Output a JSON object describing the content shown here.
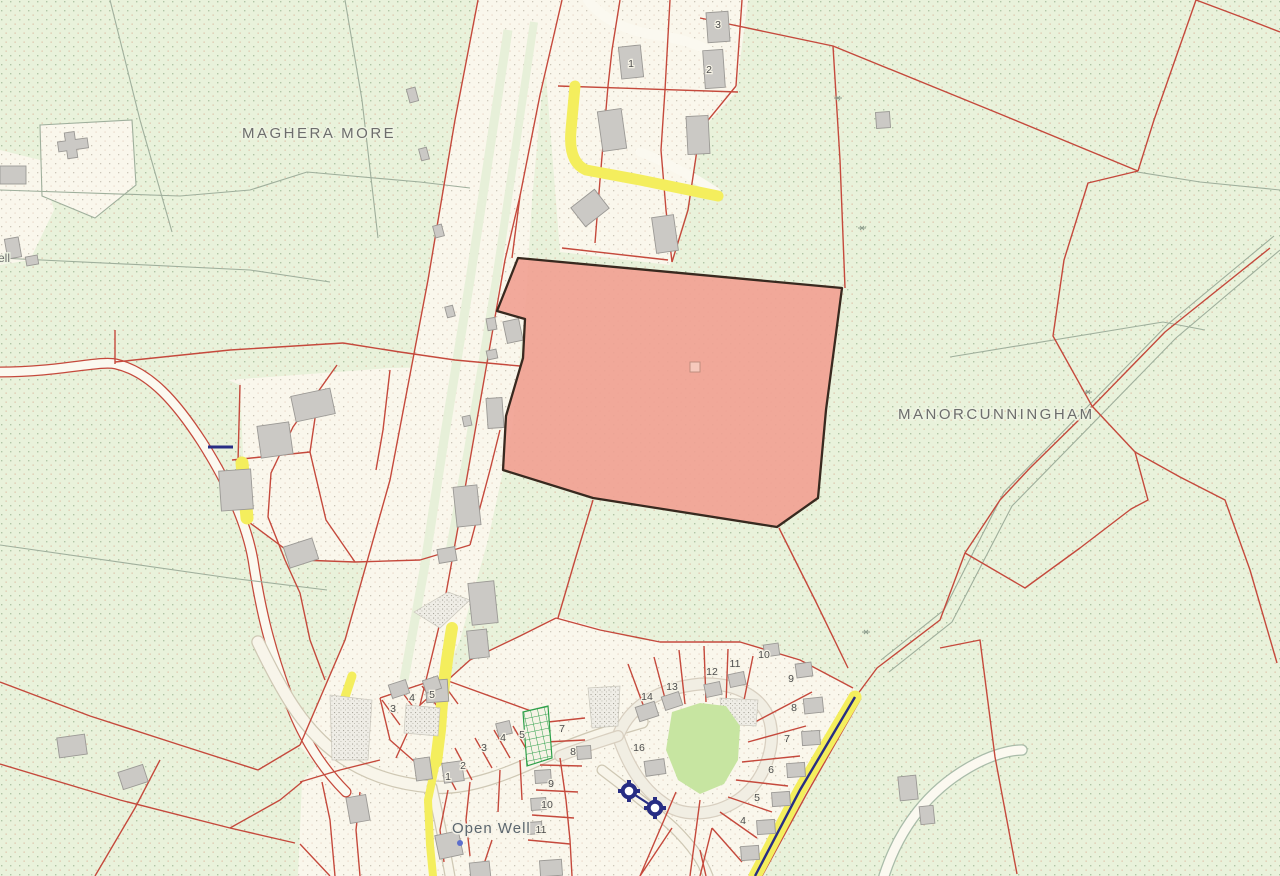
{
  "title": "Land parcel map",
  "place_labels": {
    "townland_1": "MAGHERA MORE",
    "townland_2": "MANORCUNNINGHAM",
    "well_label": "Open Well",
    "edge_label": "ell"
  },
  "plot_numbers": {
    "north": [
      "1",
      "2",
      "3"
    ],
    "estate": [
      "14",
      "13",
      "12",
      "11",
      "10",
      "9",
      "8",
      "7",
      "6",
      "5",
      "4",
      "16"
    ],
    "open_well_upper": [
      "3",
      "4",
      "5"
    ],
    "open_well_row": [
      "1",
      "2",
      "3",
      "4",
      "5"
    ],
    "open_well_col": [
      "7",
      "8",
      "9",
      "10",
      "11"
    ]
  },
  "highlighted_parcel": {
    "fill": "#F1A294",
    "outline": "#38291F",
    "opacity": 0.92
  },
  "colors": {
    "background_green": "#E9F2DB",
    "parcel_cream": "#FAF7EC",
    "stripe_green": "#E7F0D9",
    "boundary_red": "#C5493C",
    "townland_gray": "#9FAF9C",
    "road_yellow": "#F4EE5D",
    "building_gray": "#CBC9C5",
    "building_outline": "#9B9995",
    "water_navy": "#272D84",
    "green_space": "#C7E5A1",
    "hatch_green": "#2FA04A",
    "stipple_gray": "#ABA89F",
    "label_gray": "#6D6D6D",
    "well_label_gray": "#5B666E",
    "number_gray": "#4D4D4D"
  },
  "symbols": {
    "water_pump_count": 2,
    "well_dot_count": 1
  }
}
